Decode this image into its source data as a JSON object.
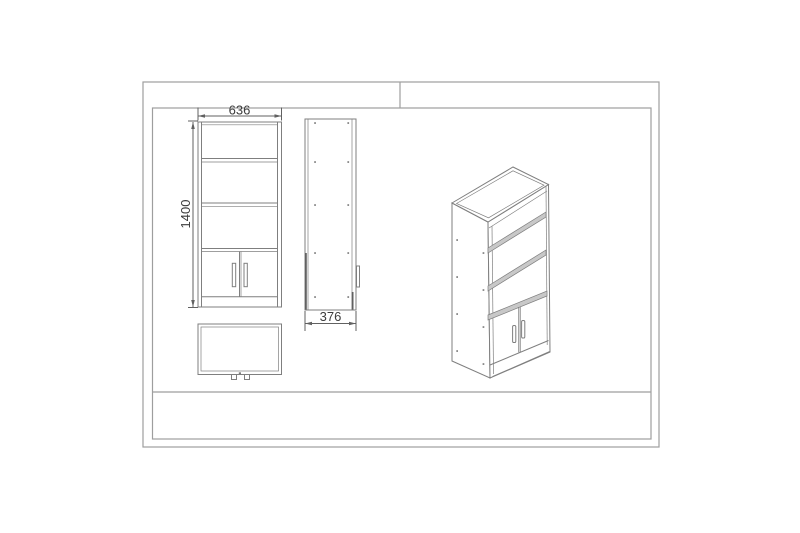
{
  "colors": {
    "background": "#ffffff",
    "frame": "#9e9e9e",
    "line": "#7f7f7f",
    "dark": "#616161",
    "shelf": "#c8c8c8",
    "text": "#3c3c3c"
  },
  "dimensions": {
    "width": "636",
    "height": "1400",
    "depth": "376"
  }
}
